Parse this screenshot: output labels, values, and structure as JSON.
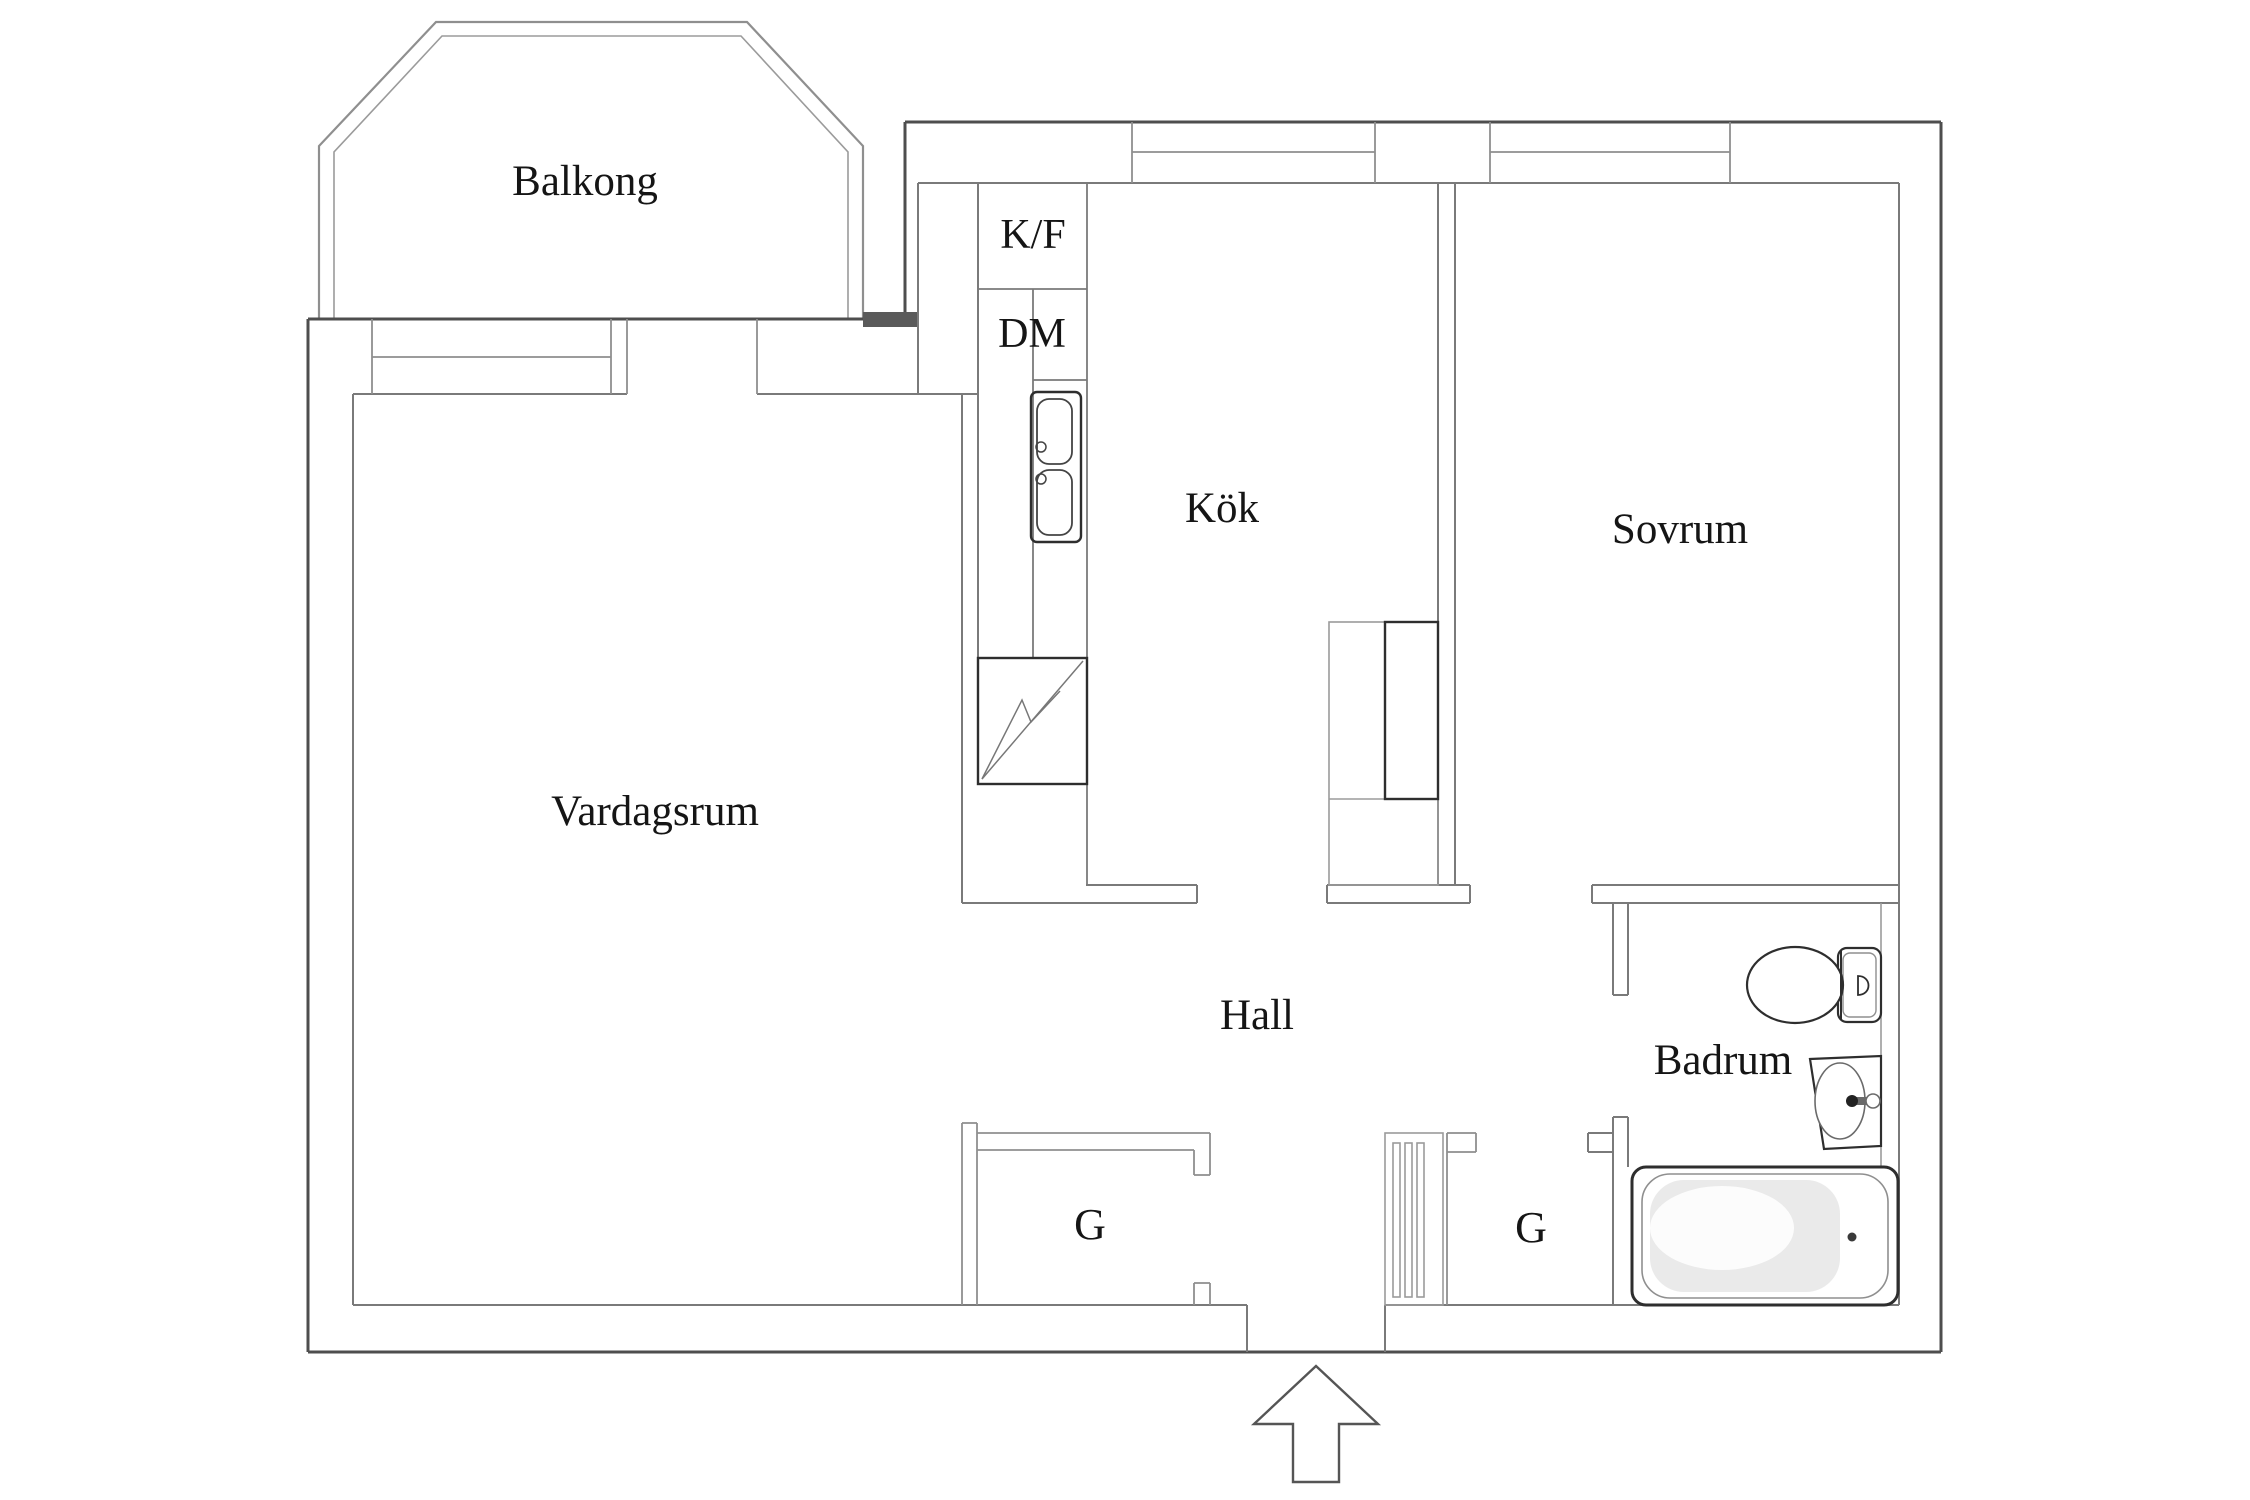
{
  "plan": {
    "type": "apartment-floor-plan",
    "rooms": {
      "balkong": {
        "label": "Balkong"
      },
      "vardagsrum": {
        "label": "Vardagsrum"
      },
      "kok": {
        "label": "Kök"
      },
      "sovrum": {
        "label": "Sovrum"
      },
      "hall": {
        "label": "Hall"
      },
      "badrum": {
        "label": "Badrum"
      }
    },
    "appliances": {
      "fridge_freezer": {
        "label": "K/F"
      },
      "dishwasher": {
        "label": "DM"
      }
    },
    "closets": {
      "left": {
        "label": "G"
      },
      "right": {
        "label": "G"
      }
    },
    "fixtures": [
      "double-bowl-kitchen-sink",
      "electric-stove",
      "kitchen-cabinet",
      "toilet",
      "washbasin",
      "bathtub",
      "radiator-grille",
      "entrance-arrow",
      "windows",
      "balcony-railing"
    ],
    "colors": {
      "background": "#ffffff",
      "outer_wall": "#4e4e4e",
      "inner_wall": "#7a7a7a",
      "light_line": "#9b9b9b",
      "fixture_dark": "#2e2e2e",
      "tub_shade": "#d9d9d9",
      "text": "#151515"
    }
  }
}
